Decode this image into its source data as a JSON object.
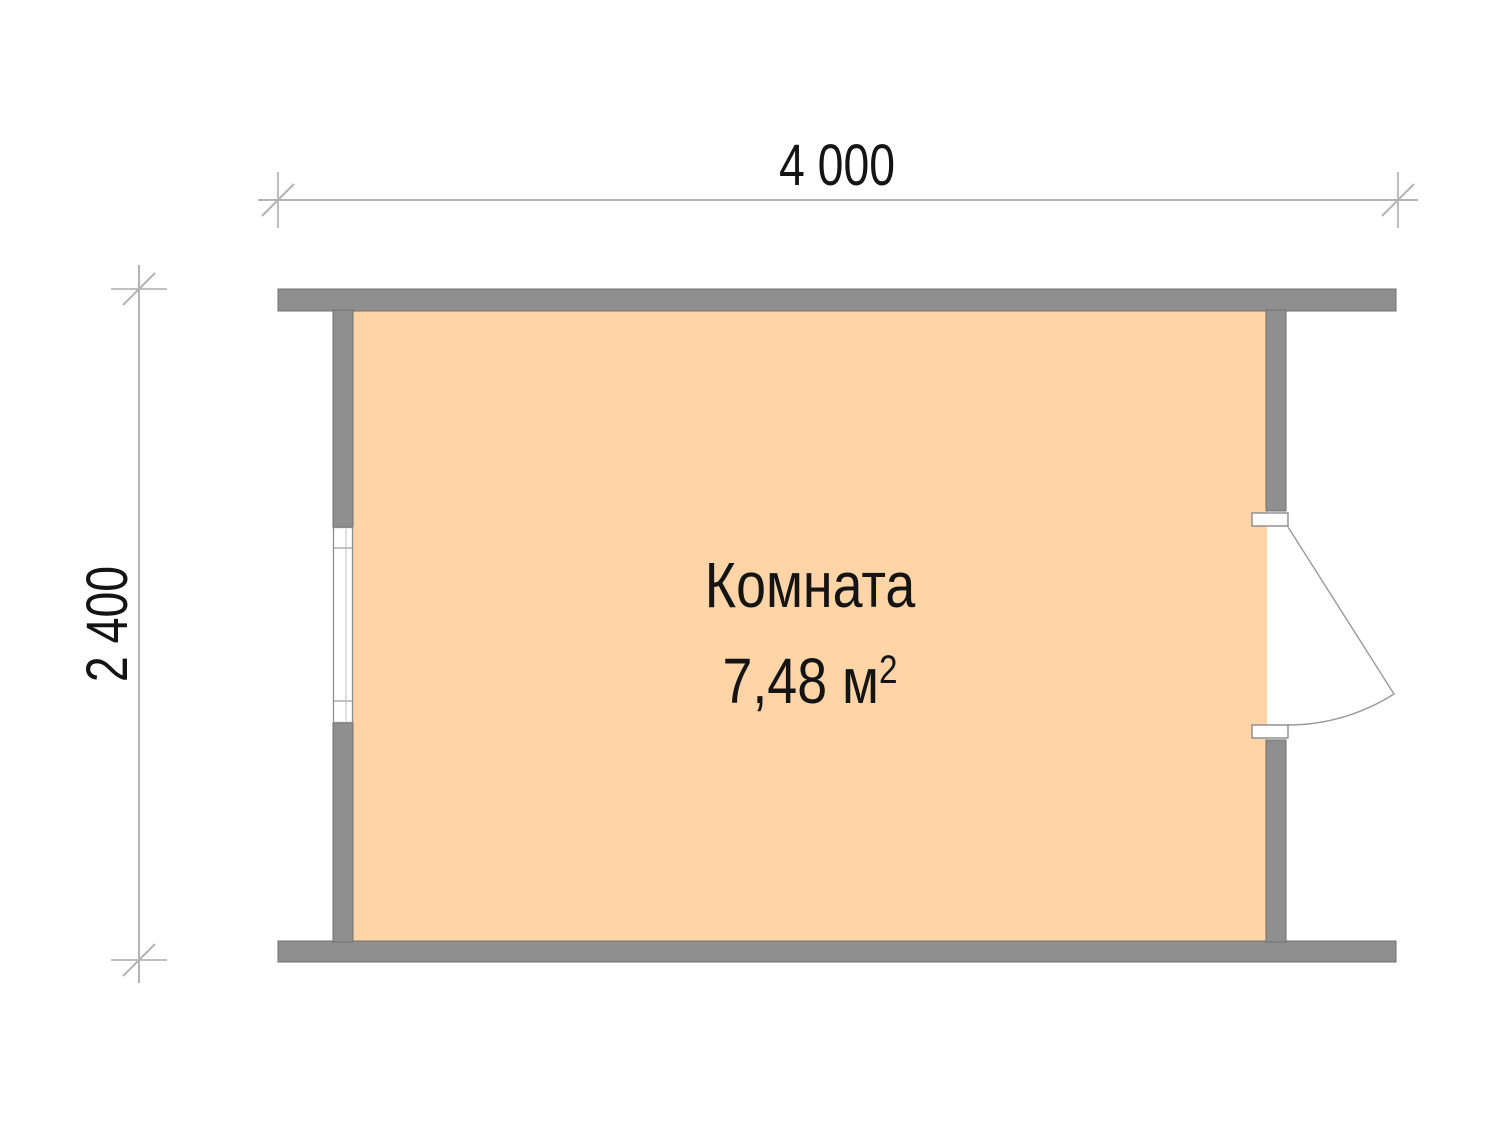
{
  "plan": {
    "type": "floor-plan",
    "dimensions": {
      "width_label": "4 000",
      "height_label": "2 400"
    },
    "room": {
      "name": "Комната",
      "area_label": "7,48 м",
      "area_sup": "2"
    },
    "symbols": {
      "window": "window-symbol-left-wall",
      "door": "door-swing-symbol-right-wall"
    }
  },
  "colors": {
    "page": "#ffffff",
    "room_fill": "#ffd5a7",
    "wall": "#8f8f8f",
    "wall_edge": "#6f6f6f",
    "dim_line": "#9b9b9b",
    "tick_slash": "#b3b3b3",
    "opening_fill": "#ffffff",
    "text": "#141414"
  }
}
